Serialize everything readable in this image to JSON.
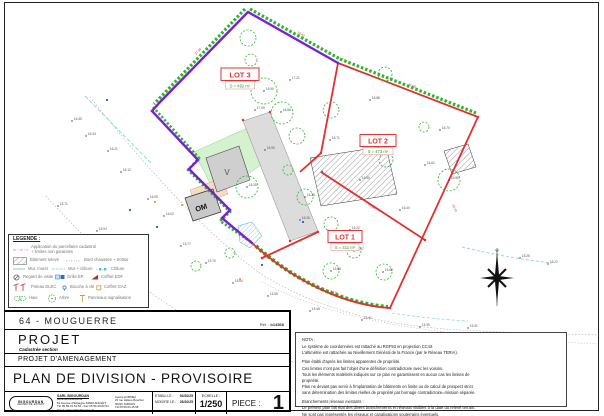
{
  "colors": {
    "boundary_red": "#e03030",
    "road_purple": "#7b1fd4",
    "hedge_green": "#2db52d",
    "water_cyan": "#8fd8ea",
    "lot_area_green": "#2a9d2a"
  },
  "plan": {
    "lots": [
      {
        "name": "LOT 1",
        "area": "S = 411 m²"
      },
      {
        "name": "LOT 2",
        "area": "S = 473 m²"
      },
      {
        "name": "LOT 3",
        "area": "S = 492 m²"
      }
    ],
    "zones": {
      "v_label": "V",
      "om_label": "OM"
    },
    "trees": [
      [
        248,
        38,
        8
      ],
      [
        251,
        60,
        6
      ],
      [
        264,
        91,
        13
      ],
      [
        282,
        113,
        11
      ],
      [
        297,
        136,
        8
      ],
      [
        385,
        74,
        7
      ],
      [
        331,
        110,
        8
      ],
      [
        424,
        127,
        5
      ],
      [
        449,
        180,
        11
      ],
      [
        386,
        160,
        7
      ],
      [
        305,
        197,
        8
      ],
      [
        331,
        224,
        7
      ],
      [
        354,
        251,
        7
      ],
      [
        331,
        271,
        8
      ],
      [
        384,
        272,
        8
      ],
      [
        288,
        170,
        5
      ],
      [
        247,
        187,
        11
      ],
      [
        230,
        253,
        5
      ],
      [
        196,
        266,
        5
      ]
    ],
    "spot_points": [
      [
        72,
        121,
        "16.45"
      ],
      [
        86,
        136,
        "16.43"
      ],
      [
        108,
        151,
        "16.21"
      ],
      [
        58,
        206,
        "15.71"
      ],
      [
        97,
        231,
        "15.94"
      ],
      [
        121,
        172,
        "16.12"
      ],
      [
        148,
        199,
        "16.05"
      ],
      [
        164,
        216,
        "16.02"
      ],
      [
        181,
        246,
        "15.77"
      ],
      [
        206,
        263,
        "15.70"
      ],
      [
        233,
        283,
        "15.64"
      ],
      [
        268,
        296,
        "15.55"
      ],
      [
        310,
        311,
        "15.48"
      ],
      [
        362,
        320,
        "15.41"
      ],
      [
        420,
        327,
        "15.35"
      ],
      [
        468,
        328,
        "15.31"
      ],
      [
        520,
        258,
        "15.26"
      ],
      [
        548,
        264,
        "15.22"
      ],
      [
        255,
        110,
        "17.05"
      ],
      [
        290,
        80,
        "17.21"
      ],
      [
        370,
        100,
        "16.88"
      ],
      [
        440,
        130,
        "16.70"
      ],
      [
        265,
        150,
        "16.90"
      ],
      [
        330,
        140,
        "16.71"
      ],
      [
        360,
        180,
        "16.55"
      ],
      [
        300,
        220,
        "16.30"
      ],
      [
        350,
        230,
        "16.22"
      ],
      [
        400,
        210,
        "16.40"
      ],
      [
        425,
        165,
        "16.62"
      ],
      [
        264,
        91,
        "16.95"
      ],
      [
        281,
        112,
        "16.86"
      ],
      [
        449,
        180,
        "16.58"
      ],
      [
        331,
        271,
        "15.88"
      ],
      [
        383,
        272,
        "15.80"
      ],
      [
        354,
        251,
        "15.97"
      ],
      [
        305,
        197,
        "16.35"
      ],
      [
        247,
        187,
        "16.28"
      ]
    ],
    "edge_lengths": [
      [
        196,
        55,
        -46,
        "27.94"
      ],
      [
        297,
        33,
        28,
        "19.43"
      ],
      [
        408,
        85,
        22,
        "31.08"
      ],
      [
        452,
        205,
        65,
        "26.42"
      ],
      [
        330,
        292,
        16,
        "24.15"
      ],
      [
        368,
        205,
        33,
        "21.60"
      ]
    ],
    "blue_marks": [
      [
        107,
        100
      ],
      [
        130,
        210
      ],
      [
        157,
        227
      ],
      [
        262,
        265
      ],
      [
        303,
        222
      ]
    ],
    "orange_marks": [
      [
        155,
        202
      ],
      [
        182,
        205
      ],
      [
        240,
        279
      ]
    ]
  },
  "legend": {
    "title": "LEGENDE :",
    "items": [
      {
        "label": "Application du parcellaire cadastral"
      },
      {
        "label": "+ limites non garanties"
      },
      {
        "label": "Bâtiment relevé"
      },
      {
        "label": "Bord chaussée + trottoir"
      },
      {
        "label": "Mur, muret"
      },
      {
        "label": "Mur + clôture"
      },
      {
        "label": "Clôture"
      },
      {
        "label": "Regard de visite"
      },
      {
        "label": "Grille EP"
      },
      {
        "label": "Coffret EDF"
      },
      {
        "label": "Poteau ELEC"
      },
      {
        "label": "Bouche à clé"
      },
      {
        "label": "Coffret GAZ"
      },
      {
        "label": "Haie"
      },
      {
        "label": "Arbre"
      },
      {
        "label": "Panneaux signalisation"
      }
    ]
  },
  "title_block": {
    "commune": "64 - MOUGUERRE",
    "ref_label": "Réf. :",
    "ref_value": "b14568",
    "project": "PROJET",
    "cadastre": "Cadastrée section",
    "subtitle": "PROJET D'AMENAGEMENT",
    "title": "PLAN DE DIVISION - PROVISOIRE",
    "logo": {
      "line1": "BIGOURDAN",
      "line2": "GÉOMÈTRE-EXPERT"
    },
    "firm": {
      "name": "SARL BIGOURDAN",
      "lines": [
        "Géomètres-Experts",
        "51 Avenue d'Espagne 64600 ANGLET",
        "Tél 05.59.31.51.52 - Fax 05.59.43.82.94",
        "Email : bigourdan@orange.fr"
      ],
      "office2": [
        "Centre HORNEA",
        "23 rue Hélène Boucher",
        "40220 TARNOS",
        "Tél 05.59.64.15.58"
      ]
    },
    "dates": {
      "etabli_label": "ETABLI LE :",
      "etabli": "03/10/25",
      "modifie_label": "MODIFIE LE :",
      "modifie": "28/10/25"
    },
    "scale_label": "ECHELLE :",
    "scale": "1/250",
    "piece_label": "PIECE :",
    "piece": "1"
  },
  "nota": {
    "title": "NOTA :",
    "lines": [
      "Le système de coordonnées est rattaché au RGF93 en projection CC43.",
      "L'altimétrie est rattachée au Nivellement Général de la France (par le Réseau TERIA).",
      "",
      "Plan établi d'après les limites apparentes de propriété.",
      "Ces limites n'ont pas fait l'objet d'une définition contradictoire avec les voisins.",
      "Tous les éléments matériels indiqués sur ce plan ne garantissent en aucun cas les limites de",
      "propriété.",
      "Plan ne devant pas servir à l'implantation de bâtiments en limite ou de calcul de prospect strict",
      "sans détermination des limites réelles de propriété par bornage contradictoire=mission séparée.",
      "",
      "Branchements réseaux existants :",
      "Le présent plan fait état des divers branchements et réseaux visibles à la date du relevé terrain.",
      "Ne sont pas représentés les réseaux et canalisations souterrains éventuels."
    ]
  }
}
